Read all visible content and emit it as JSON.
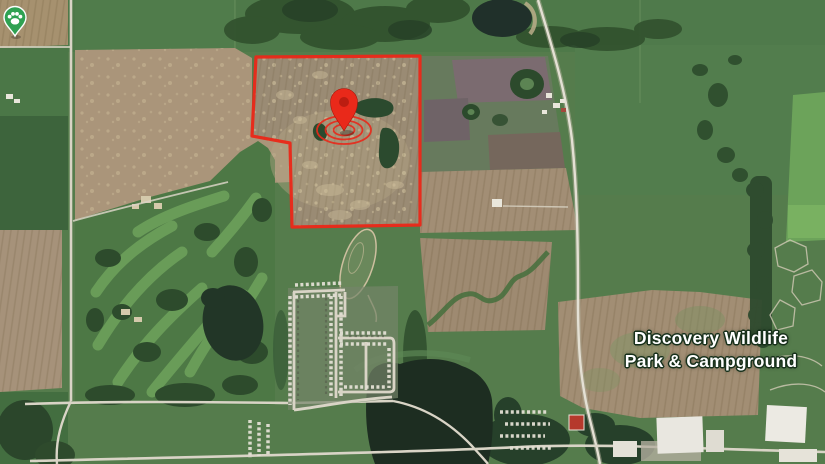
{
  "map": {
    "poi": {
      "label_line1": "Discovery Wildlife",
      "label_line2": "Park & Campground",
      "pin_color": "#2fa152",
      "pin_icon": "paw-pin-icon"
    },
    "marker": {
      "color": "#e9291a",
      "icon": "location-pin-icon"
    },
    "property_boundary": {
      "color": "#e9291a"
    }
  }
}
